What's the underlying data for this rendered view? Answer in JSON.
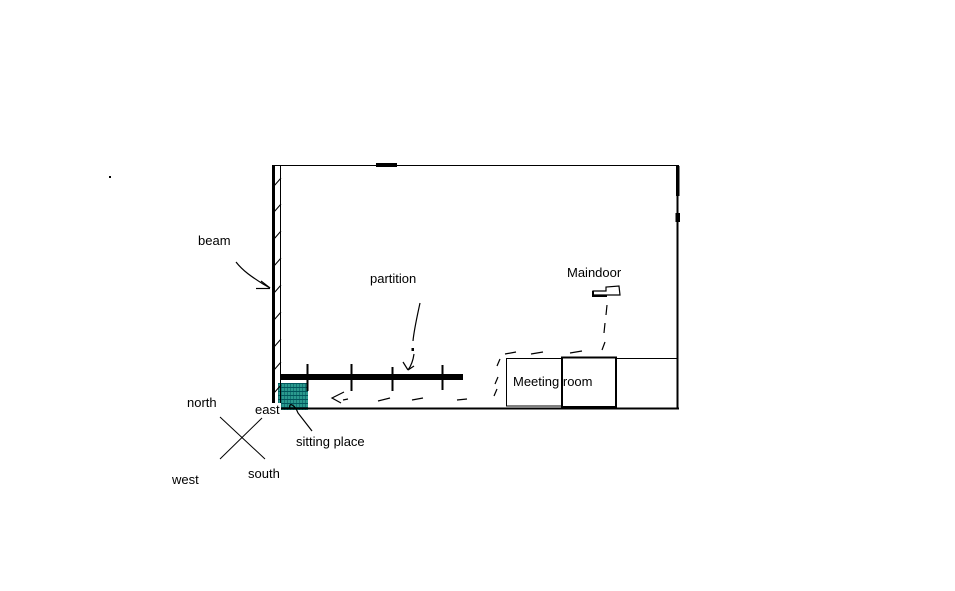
{
  "colors": {
    "background": "#ffffff",
    "ink": "#000000",
    "sitting_fill": "#2a9a8e",
    "sitting_stripe": "#00565c"
  },
  "labels": {
    "beam": "beam",
    "partition": "partition",
    "maindoor": "Maindoor",
    "meeting_room": "Meeting room",
    "sitting_place": "sitting place"
  },
  "compass": {
    "north": "north",
    "east": "east",
    "west": "west",
    "south": "south"
  }
}
